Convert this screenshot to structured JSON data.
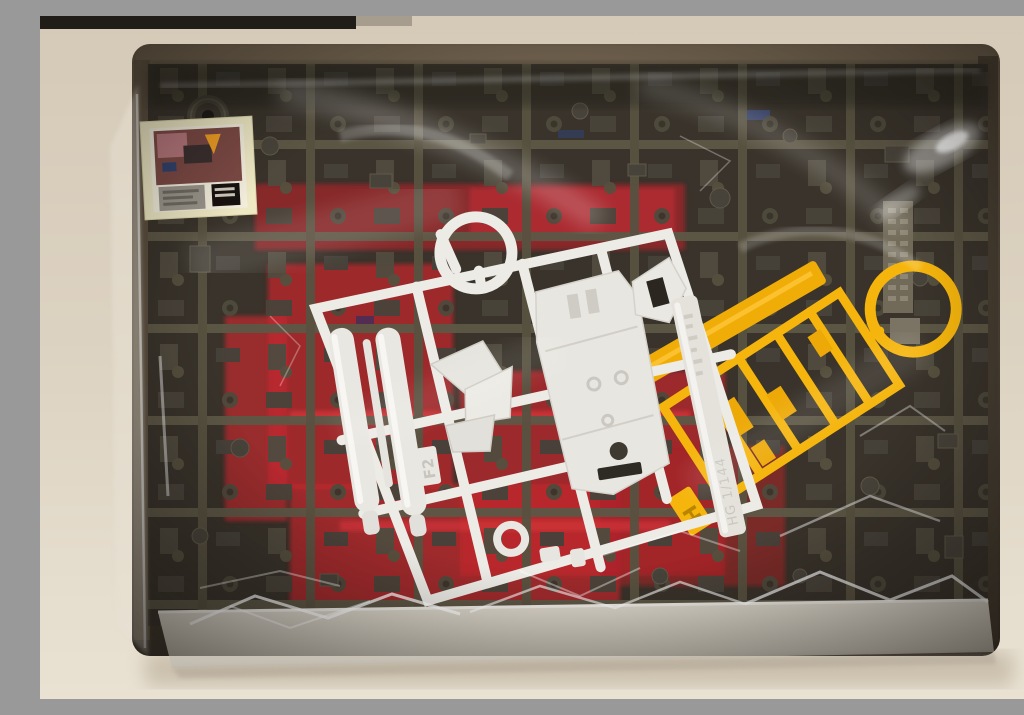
{
  "scene": {
    "type": "photograph",
    "subject": "Opened plastic model kit box with shrink-wrapped sprue runners viewed from above",
    "items_visible": [
      "cardboard box",
      "clear shrink wrap with glare highlights",
      "dark olive-gray sprue runners with many small parts",
      "red sprue runner beneath the dark runners",
      "white sprue runner with long cylinder parts and a large body part",
      "yellow sprue runner with a ring handle",
      "small sticker sheet with cream border",
      "molded tag with embossed text on dark runner",
      "white box tray edge at the bottom"
    ]
  },
  "labels": {
    "white_runner_gate_tag": "F2",
    "yellow_runner_gate_tag": "H",
    "white_runner_embossed": "HG 1/144"
  },
  "colors": {
    "wall": "#ddd2c0",
    "shelf_bar": "#201d19",
    "box_cardboard": "#5d5040",
    "box_interior": "#38322a",
    "sprue_olive": "#5b5645",
    "sprue_red": "#bf2a2c",
    "runner_white": "#eae8e2",
    "runner_yellow": "#f5b50d",
    "sticker_sheet": "#eee8c4",
    "box_tray": "#d5cfc4"
  }
}
